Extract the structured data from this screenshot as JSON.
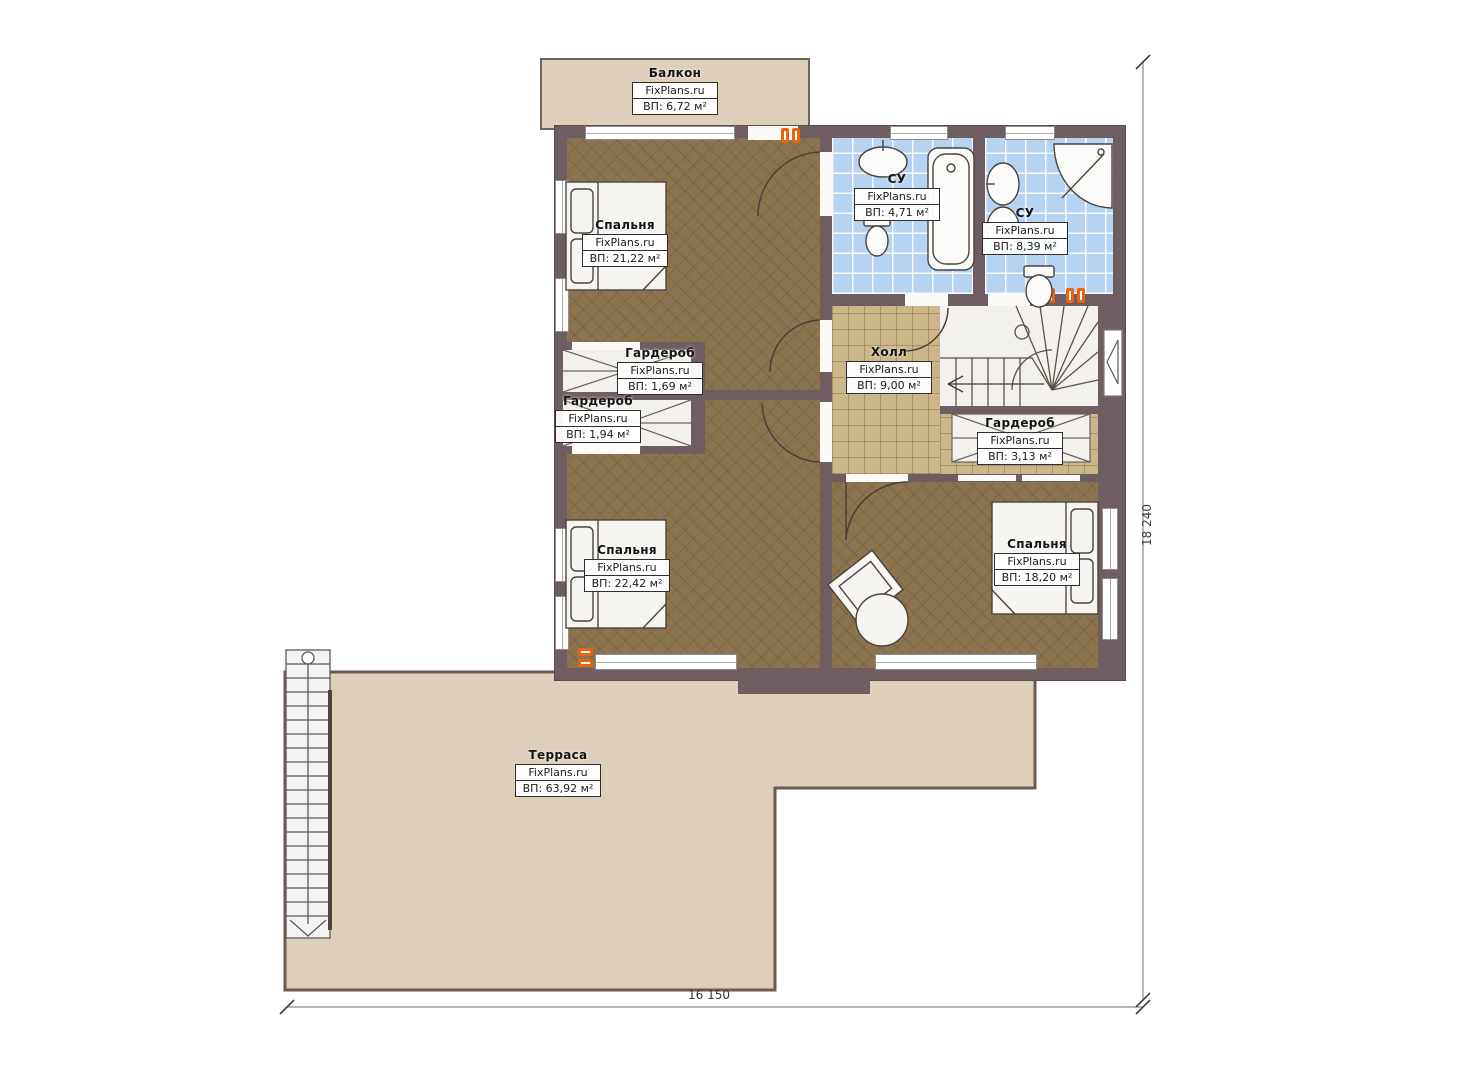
{
  "plan": {
    "type": "floor-plan",
    "watermark": "FixPlans.ru",
    "language": "ru"
  },
  "rooms": [
    {
      "id": "balcony",
      "name": "Балкон",
      "watermark": "FixPlans.ru",
      "area": "ВП: 6,72 м²"
    },
    {
      "id": "bedroom-1",
      "name": "Спальня",
      "watermark": "FixPlans.ru",
      "area": "ВП: 21,22 м²"
    },
    {
      "id": "bathroom-1",
      "name": "СУ",
      "watermark": "FixPlans.ru",
      "area": "ВП: 4,71 м²"
    },
    {
      "id": "bathroom-2",
      "name": "СУ",
      "watermark": "FixPlans.ru",
      "area": "ВП: 8,39 м²"
    },
    {
      "id": "wardrobe-1",
      "name": "Гардероб",
      "watermark": "FixPlans.ru",
      "area": "ВП: 1,69 м²"
    },
    {
      "id": "wardrobe-2",
      "name": "Гардероб",
      "watermark": "FixPlans.ru",
      "area": "ВП: 1,94 м²"
    },
    {
      "id": "hall",
      "name": "Холл",
      "watermark": "FixPlans.ru",
      "area": "ВП: 9,00 м²"
    },
    {
      "id": "wardrobe-3",
      "name": "Гардероб",
      "watermark": "FixPlans.ru",
      "area": "ВП: 3,13 м²"
    },
    {
      "id": "bedroom-2",
      "name": "Спальня",
      "watermark": "FixPlans.ru",
      "area": "ВП: 22,42 м²"
    },
    {
      "id": "bedroom-3",
      "name": "Спальня",
      "watermark": "FixPlans.ru",
      "area": "ВП: 18,20 м²"
    },
    {
      "id": "terrace",
      "name": "Терраса",
      "watermark": "FixPlans.ru",
      "area": "ВП: 63,92 м²"
    }
  ],
  "dimensions": {
    "bottom": "16 150",
    "right": "18 240"
  },
  "colors": {
    "wall": "#6e5d61",
    "wood_floor": "#8b744f",
    "tile_blue": "#b7d3f2",
    "tile_tan": "#cbb68a",
    "terrace": "#ddcfb9",
    "radiator": "#e8650e"
  }
}
